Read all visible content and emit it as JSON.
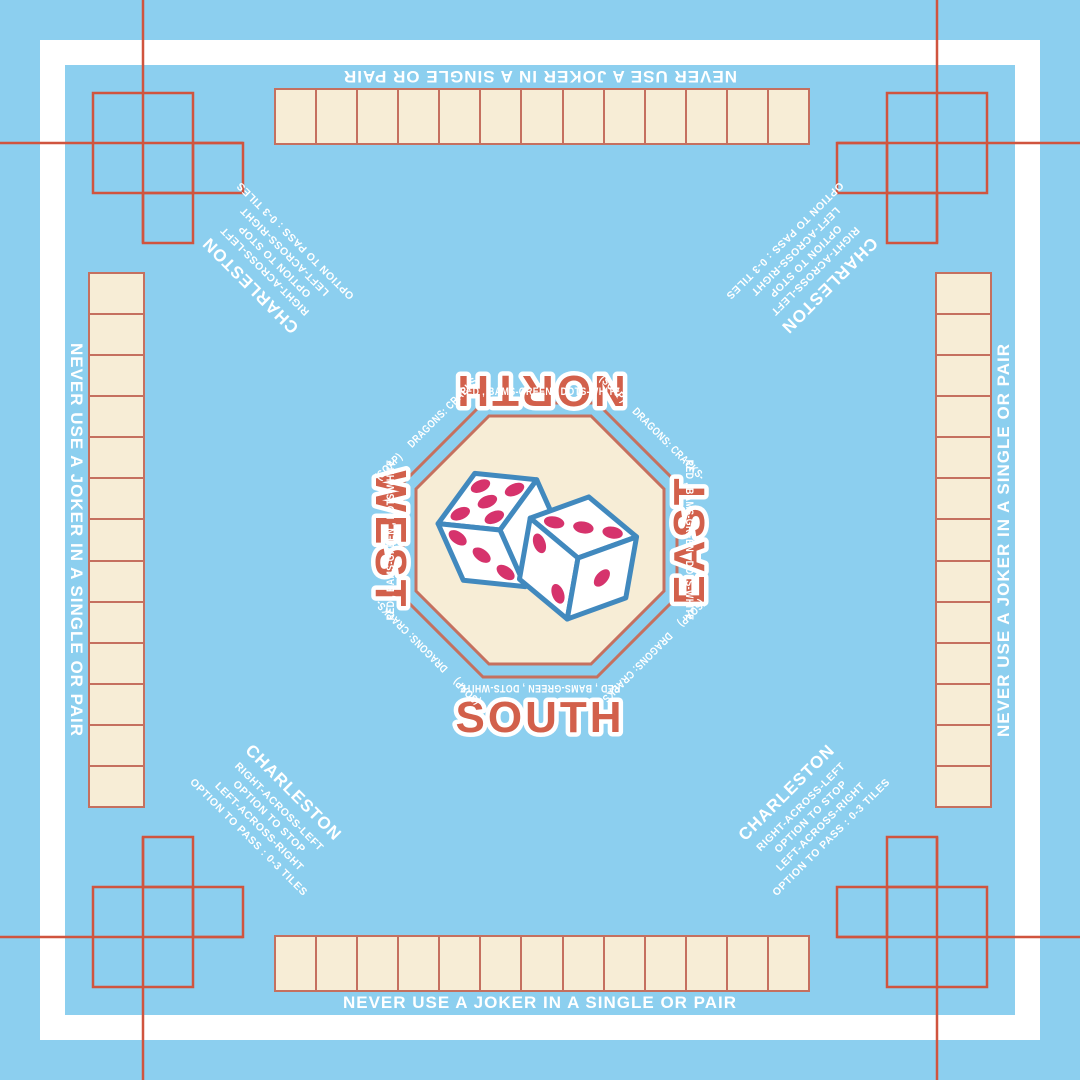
{
  "edge_warning": "NEVER USE A JOKER IN A SINGLE OR PAIR",
  "directions": {
    "north": "NORTH",
    "south": "SOUTH",
    "east": "EAST",
    "west": "WEST"
  },
  "charleston": {
    "title": "CHARLESTON",
    "lines": [
      "RIGHT-ACROSS-LEFT",
      "OPTION TO STOP",
      "LEFT-ACROSS-RIGHT",
      "OPTION TO PASS :  0-3 TILES"
    ]
  },
  "octagon": {
    "side_text": "RED , BAMS-GREEN , DOTS-WHITE",
    "soap": "(SOAP)",
    "dragons": "DRAGONS: CRACKS-"
  },
  "racks": {
    "count": 4,
    "cells_per_rack": 13
  },
  "dice": {
    "left_die": {
      "top": 5,
      "front": 3
    },
    "right_die": {
      "top": 3,
      "left": 2,
      "right": 1
    }
  },
  "colors": {
    "background": "#8CCFEF",
    "frame": "#FFFFFF",
    "tile_cream": "#F7EDD6",
    "corner_line": "#D0543E",
    "rack_border": "#C5705F",
    "octagon_border": "#C5705F",
    "direction_label": "#D2604B",
    "direction_outline": "#FFFFFF",
    "text": "#FFFFFF",
    "die_outline": "#4189BE",
    "pip": "#D6336C"
  }
}
